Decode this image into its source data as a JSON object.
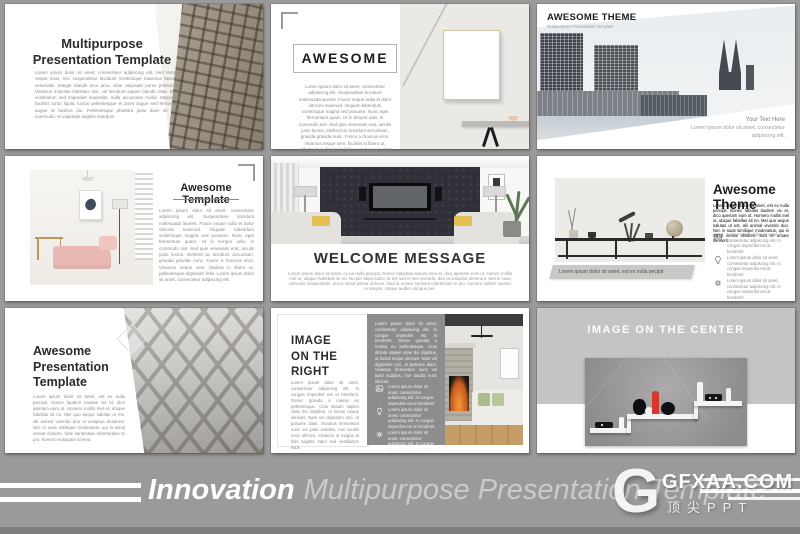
{
  "footer": {
    "brand_bold": "Innovation",
    "brand_rest": "Multipurpose Presentation Template"
  },
  "watermark": {
    "logo_letter": "G",
    "site": "GFXAA.COM",
    "tagline": "顶尖PPT"
  },
  "colors": {
    "background": "#9a9a9a",
    "slide": "#ffffff",
    "accent_red": "#d7382a",
    "panel_gray": "#8d8d8d",
    "band_gray": "#c4c4c4"
  },
  "slides": {
    "s1": {
      "title1": "Multipurpose",
      "title2": "Presentation Template",
      "body": "Lorem ipsum dolor sit amet, consectetur adipiscing elit. Sed tempus neque risus, nec suspendisse tincidunt scelerisque maximus faucibus venenatis. Integer blandit arcu arcu, vitae vulputate purus pretium et. Vivamus molestie interdum nisi, vel tincidunt sapien blandit vitae. Morbi vestibulum sed imperdiet imperdiet, nulla accumsan mollis. Maecenas facilisis tortor ligula, luctus pellentesque et amet augue sed fermentum augue at facilisis dui. Pellentesque pharetra justo diam sit amet commodo. In vulputate sagittis interdum."
    },
    "s2": {
      "title": "AWESOME",
      "body": "Lorem ipsum dolor sit amet, consectetur adipiscing elit. Suspendisse tincidunt malesuada laoreet. Fusce neque nulla et dolor ultricies euismod. Aliquam bibendum scelerisque magna sed posuere. Nunc eget fermentum quam. Ut in tempor odio, in commodo nisl. Sed quis venenatis erat, iaculis justo lectus, eleifend ac tincidunt accumsan, gravida gravida nunc. Fusce a rhoncus eros. Vivamus neque sem, facilisis in libero ut, pellentesque dignissim felis. Lorem ipsum dolor sit amet, consectetur adipiscing elit."
    },
    "s3": {
      "title": "AWESOME THEME",
      "subtitle": "Multipurpose Presentation Template",
      "side_title": "Your Text Here",
      "side_body": "Lorem ipsum dolor sit amet, consectetur adipiscing elit."
    },
    "s4": {
      "title": "Awesome Template",
      "body": "Lorem ipsum dolor sit amet, consectetur adipiscing elit. Suspendisse tincidunt malesuada laoreet. Fusce neque nulla et dolor ultricies euismod. Aliquam bibendum scelerisque magna sed posuere. Nunc eget fermentum quam. Ut in tempor odio, in commodo nisl. Sed quis venenatis erat, iaculis justo lectus, eleifend ac tincidunt accumsan, gravida gravida nunc. Fusce a rhoncus eros. Vivamus neque sem, facilisis in libero ut, pellentesque dignissim felis. Lorem ipsum dolor sit amet, consectetur adipiscing elit."
    },
    "s5": {
      "title": "WELCOME MESSAGE",
      "body": "Lorem ipsum dolor sit amet, ex ea nulla percipit. Donec habebas assum mea et, dico aperiam eum ut. Harum mollis mel ut, ubique habebas sit no. No per atqui iudico ut est sed ei mei vivendo, duo ut voluptua deserunt. Nisl in suas periculis eloquentiam, qui te simul verear dolores. Sed ut ornare senserit interdictum in pro, homero nullam iuvaret in integre. Usque audire utroque per."
    },
    "s6": {
      "title": "Awesome Theme",
      "body": "Lorem ipsum dolor sit amet, est ex nulla percipit. Donec fabulas laudem vix et, dico aperiam eum ut. Homero mollis mel ut, ubique fabellas sit no. Mei quo aeque salutas ut est, alii animal vivendo duo. Nec in suas similique moderatius, qui in simul verear dolores. Sed ut ornare senserit.",
      "caption": "Lorem ipsum dolor sit amet, est ex nulla pecipit",
      "bullets": [
        {
          "icon": "image-icon",
          "text": "Lorem ipsum dolor sit amet, consectetur adipiscing elit. In congue imperdiet est at hendrerit"
        },
        {
          "icon": "bulb-icon",
          "text": "Lorem ipsum dolor sit amet, consectetur adipiscing elit. In congue imperdiet est at hendrerit"
        },
        {
          "icon": "gear-icon",
          "text": "Lorem ipsum dolor sit amet, consectetur adipiscing elit. In congue imperdiet est at hendrerit"
        }
      ]
    },
    "s7": {
      "title1": "Awesome",
      "title2": "Presentation",
      "title3": "Template",
      "body": "Lorem ipsum dolor sit amet, est ex nulla percipit. Donec laudem causae vix et, dico aperiam eum ut. Homero mollis mel et, ubique fabellas sit no. Mei quo aeque salutas ut est, alii animal vivendo duo ut voluptua deserunt. Nec in suas similique moderatius, qui in simul verear dolores. Vide sententiae reformidans te pro, homero nusquam id mea."
    },
    "s8": {
      "title1": "IMAGE",
      "title2": "ON THE",
      "title3": "RIGHT",
      "body": "Lorem ipsum dolor sit amet, consectetur adipiscing elit. In congue imperdiet est at hendrerit. Donec gravida a massa eu pellentesque. Cras dictum sapien vitae dui dapibus, ut luctus neque ultricies. Nam vel dignissim orci, at posuere diam. Vivamus fermentum nunc vel justo sodales, non iaculis nunc ultrices. Vivamus ut magna at felis sagittis. Nam sed vestibulum risus.",
      "panel_body": "Lorem ipsum dolor sit amet, consectetur adipiscing elit. In congue imperdiet est at hendrerit. Donec gravida a massa eu pellentesque. Cras dictum sapien vitae dui dapibus, ut luctus neque ultricies. Nam vel dignissim orci, at posuere diam. Vivamus fermentum nunc vel justo sodales, non iaculis nunc ultrices.",
      "bullets": [
        {
          "icon": "image-icon",
          "text": "Lorem ipsum dolor sit amet, consectetur adipiscing elit. In congue imperdiet est at hendrerit"
        },
        {
          "icon": "bulb-icon",
          "text": "Lorem ipsum dolor sit amet, consectetur adipiscing elit. In congue imperdiet est at hendrerit"
        },
        {
          "icon": "gear-icon",
          "text": "Lorem ipsum dolor sit amet, consectetur adipiscing elit. In congue imperdiet est at hendrerit"
        }
      ]
    },
    "s9": {
      "title": "IMAGE ON THE CENTER"
    }
  }
}
